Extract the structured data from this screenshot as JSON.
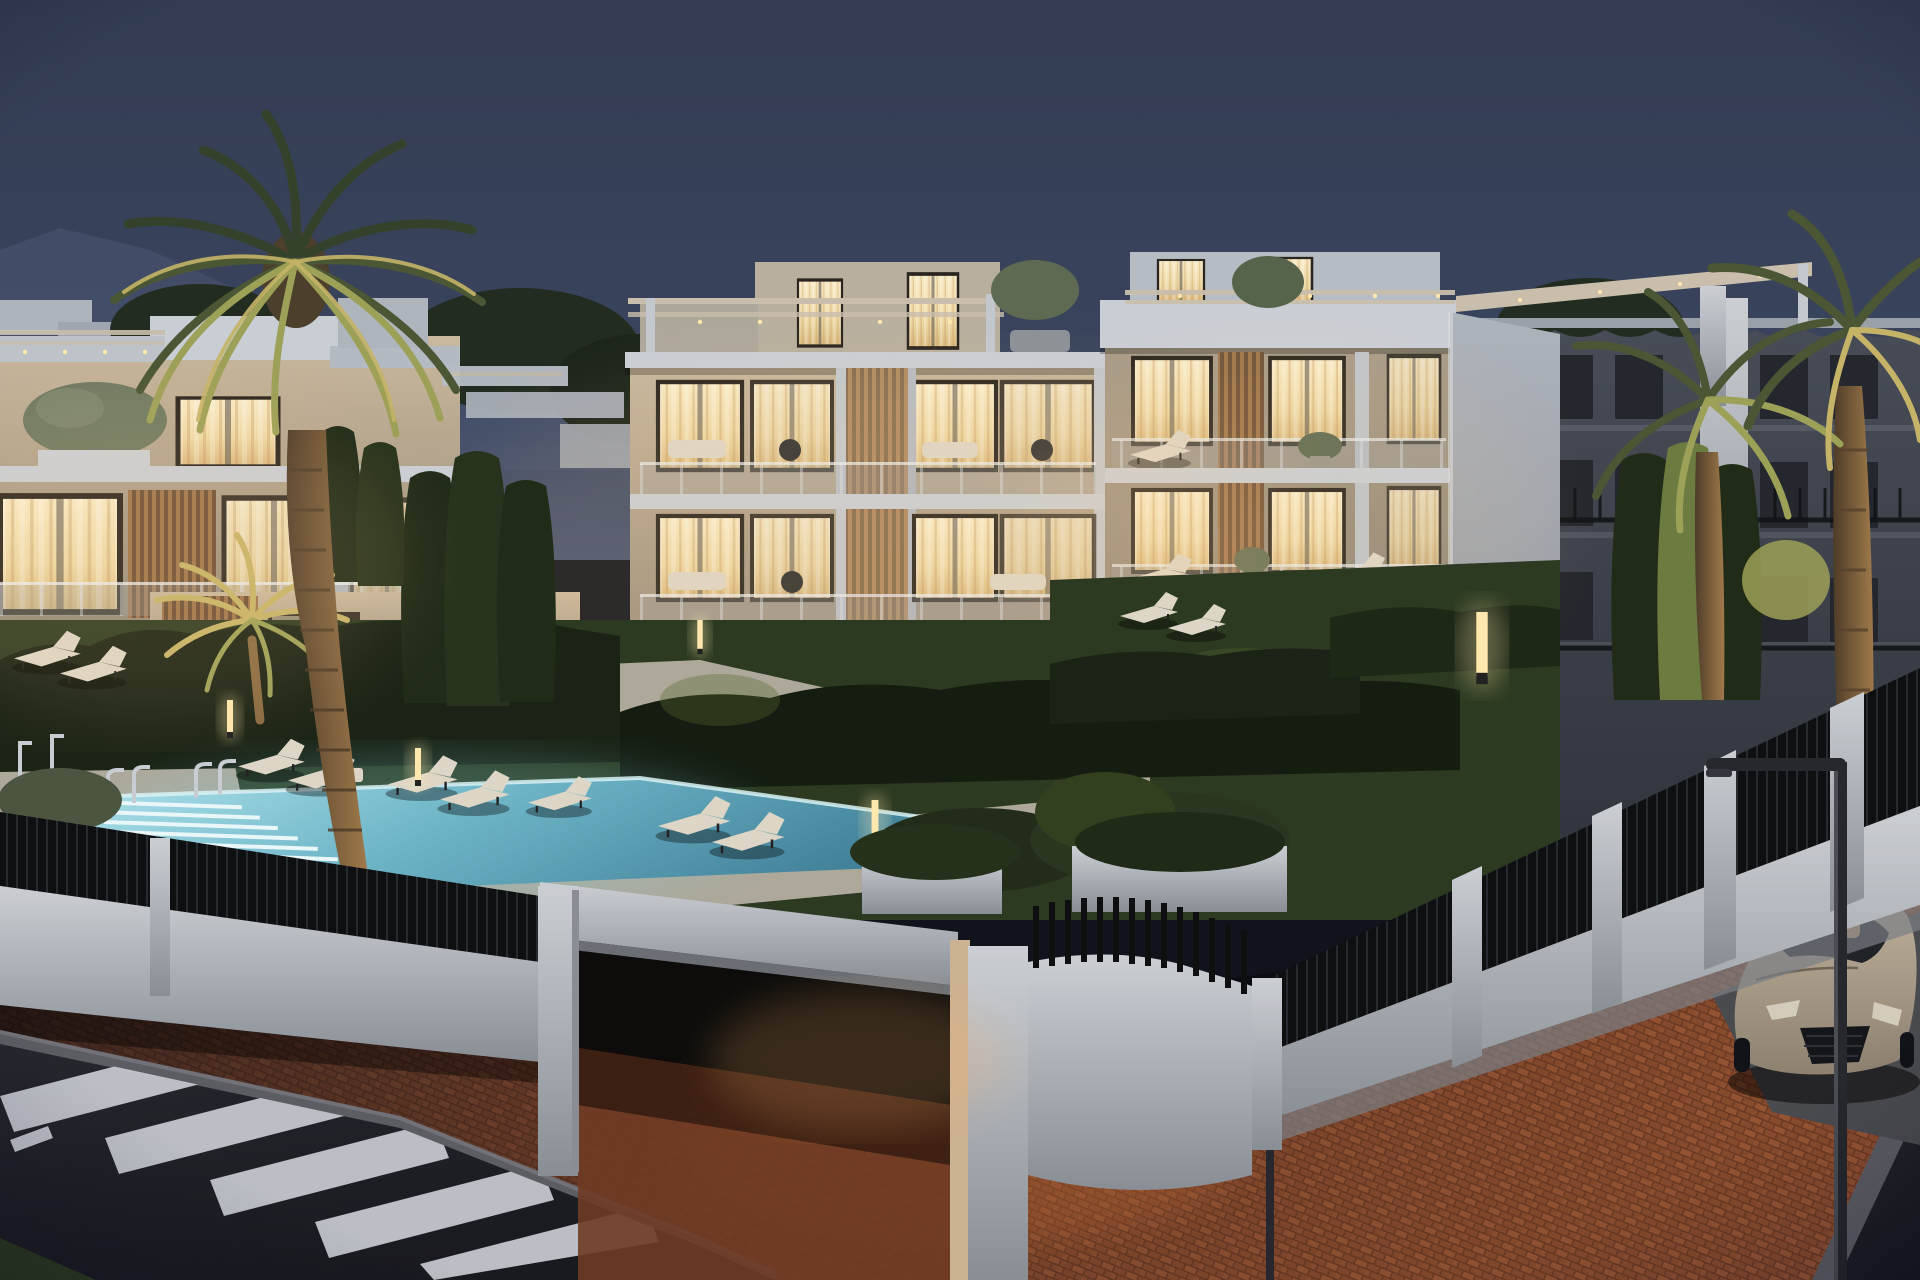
{
  "scene": {
    "type": "architectural-render",
    "time_of_day": "dusk",
    "description": "Twilight 3D rendering of a modern white apartment complex with warm lit interiors, wooden slat accents, rooftop pergola terraces, landscaped gardens with hedges and cypresses, an illuminated swimming pool with sun loungers, palm trees with accent uplighting, a white entrance portal, black slat perimeter fence on white walls, brick paved driveway and sidewalk, asphalt road with zebra crosswalk, a parked coupe and a street lamp.",
    "objects": [
      "dusk-sky",
      "mountain-ridge",
      "background-trees",
      "left-apartment-block",
      "main-apartment-building",
      "penthouse-pergola-terraces",
      "background-residence",
      "date-palm",
      "uplit-palms",
      "cypress-trees",
      "clipped-hedges",
      "swimming-pool",
      "pool-steps",
      "pool-ladder",
      "outdoor-showers",
      "sun-loungers",
      "garden-bollard-lights",
      "entrance-portal",
      "black-slat-fence",
      "white-perimeter-wall",
      "planters",
      "brick-pavement",
      "asphalt-road",
      "zebra-crosswalk",
      "parked-coupe",
      "street-lamp"
    ],
    "counts": {
      "palm_trees": 5,
      "lounger_pairs": 6,
      "bollard_lights": 6,
      "building_floors_visible": 4
    }
  },
  "colors": {
    "sky_top": "#333C52",
    "sky_mid": "#3A455E",
    "sky_horizon": "#46536F",
    "mountain": "#4A5571",
    "bg_tree": "#222C20",
    "facade_warm": "#C9B89D",
    "facade_mid": "#A89C89",
    "facade_shadow": "#867C6E",
    "roof_white": "#C9CED5",
    "wall_cool": "#AEB4BC",
    "side_face": "#8E939B",
    "wall_white": "#CBCFD4",
    "window_glow": "#F8EAC6",
    "window_mid": "#EED9A6",
    "window_amber": "#D9B97E",
    "frame_dark": "#2A261F",
    "wood_slat": "#A0754C",
    "wood_slat_dark": "#6E5138",
    "pergola": "#C9BEAC",
    "downlight": "#FFE8AE",
    "glass_rail": "#9FA8B1",
    "hedge": "#1A2315",
    "hedge_lit": "#55672F",
    "lawn": "#2C3A21",
    "lawn_lit": "#47582E",
    "cypress": "#202B18",
    "cypress_lit": "#6C7C40",
    "palm_dark": "#35422B",
    "palm_mid": "#4A5634",
    "palm_lit": "#9DA057",
    "palm_gold": "#C5B468",
    "trunk": "#6B5236",
    "trunk_lit": "#A07A4B",
    "pool_shallow": "#AEE2EA",
    "pool_mid": "#6FB6C8",
    "pool_deep": "#3F7E96",
    "pool_step": "#E9F7F8",
    "deck": "#ADA89A",
    "deck_dark": "#8C8B84",
    "fence_black": "#0D0F11",
    "fence_hi": "#262B30",
    "brick": "#8A4C2E",
    "brick_light": "#A35B38",
    "brick_dark": "#6F3B24",
    "brick_glow": "#C06B32",
    "asphalt": "#26272E",
    "asphalt_dark": "#191A20",
    "stripe": "#C9CDD3",
    "curb": "#5C5D63",
    "car_body": "#8E8170",
    "car_roof": "#BFB19D",
    "car_glass": "#202328",
    "car_interior": "#C29B6E",
    "grille": "#15161A",
    "lamp": "#26282D",
    "bg_building": "#474C56",
    "bg_building_dark": "#30343C",
    "bg_window": "#24272D",
    "railing_dark": "#101214",
    "furniture_beige": "#DDD6C6",
    "furniture_dark": "#2E2F30",
    "metal": "#C7CDD2"
  }
}
